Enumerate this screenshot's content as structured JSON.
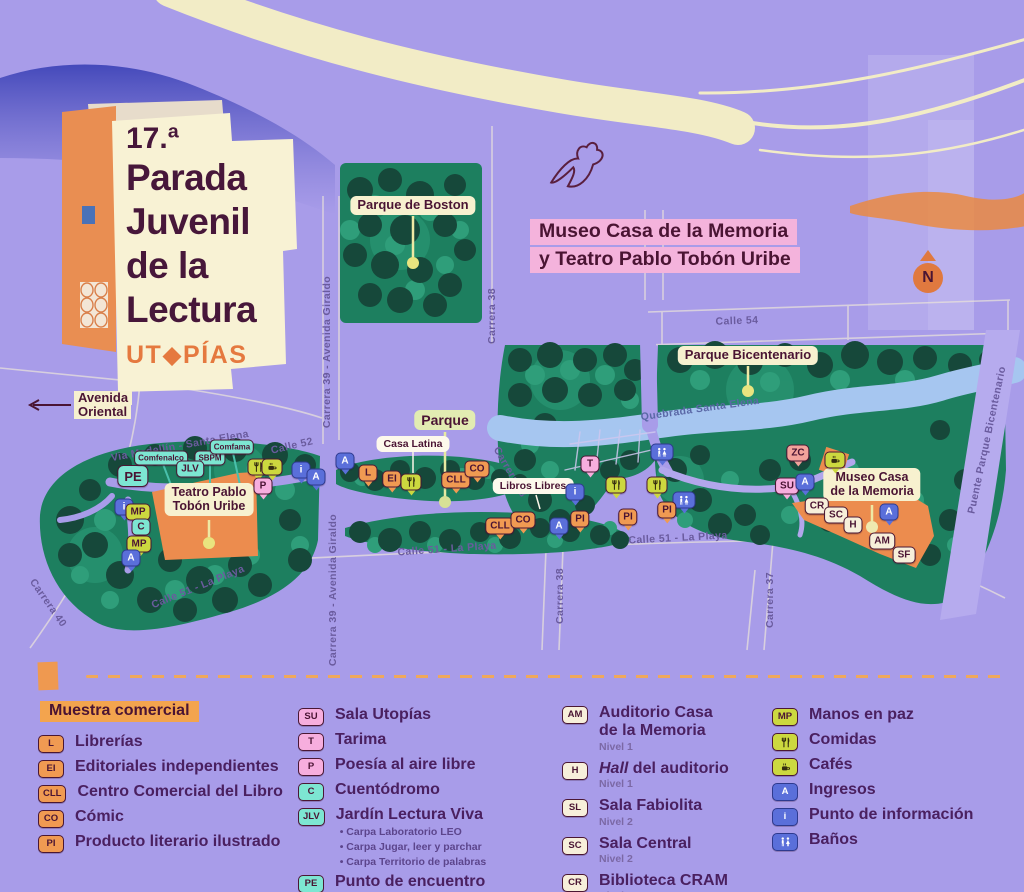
{
  "title": {
    "edition": "17.ª",
    "lines": [
      "Parada",
      "Juvenil",
      "de la",
      "Lectura"
    ],
    "brand": "UT◆PÍAS"
  },
  "colors": {
    "background": "#a89ce9",
    "park": "#1d7f5f",
    "tree_dark": "#16483a",
    "tree_light": "#2f9e7a",
    "river": "#a6c6f0",
    "building": "#ec8c4e",
    "label_cream": "#f7f1cf",
    "banner_pink": "#f4b3dc",
    "text_maroon": "#4a1433",
    "street_text": "#6a5b9e",
    "badge_orange": "#f09a52",
    "badge_pink": "#f7aede",
    "badge_teal": "#7de6d2",
    "badge_cream": "#f7efda",
    "badge_yellow": "#ccd83f",
    "badge_blue": "#5a6fda",
    "badge_salmon": "#f2a29b",
    "brand_orange": "#e5793f"
  },
  "map": {
    "compass": "N",
    "banner": [
      "Museo Casa de la Memoria",
      "y Teatro Pablo Tobón Uribe"
    ],
    "oriental": [
      "Avenida",
      "Oriental"
    ],
    "area_labels": [
      {
        "lines": [
          "Parque de Boston"
        ],
        "x": 413,
        "y": 205,
        "style": "cream",
        "size": 13
      },
      {
        "lines": [
          "Parque Bicentenario"
        ],
        "x": 748,
        "y": 355,
        "style": "cream",
        "size": 13
      },
      {
        "lines": [
          "Museo Casa",
          "de la Memoria"
        ],
        "x": 872,
        "y": 477,
        "style": "cream",
        "size": 12.5
      },
      {
        "lines": [
          "Teatro Pablo",
          "Tobón Uribe"
        ],
        "x": 209,
        "y": 492,
        "style": "cream",
        "size": 12.5
      },
      {
        "lines": [
          "Parque"
        ],
        "x": 445,
        "y": 419,
        "style": "pale",
        "size": 14
      },
      {
        "lines": [
          "Casa Latina"
        ],
        "x": 413,
        "y": 445,
        "style": "white",
        "size": 10.5
      },
      {
        "lines": [
          "Libros Libres"
        ],
        "x": 533,
        "y": 487,
        "style": "white",
        "size": 10.5
      }
    ],
    "street_labels": [
      {
        "text": "Via Medellín - Santa Elena",
        "x": 180,
        "y": 446,
        "rot": -10
      },
      {
        "text": "Calle 52",
        "x": 292,
        "y": 446,
        "rot": -13
      },
      {
        "text": "Calle 54",
        "x": 737,
        "y": 321,
        "rot": -2
      },
      {
        "text": "Calle 51 - La Playa",
        "x": 198,
        "y": 587,
        "rot": -22
      },
      {
        "text": "Calle 51 - La Playa",
        "x": 447,
        "y": 549,
        "rot": -4
      },
      {
        "text": "Calle 51 - La Playa",
        "x": 678,
        "y": 538,
        "rot": -3
      },
      {
        "text": "Carrera 40",
        "x": 48,
        "y": 603,
        "rot": 55
      },
      {
        "text": "Carrera 39 - Avenida Giraldo",
        "x": 327,
        "y": 352,
        "rot": -90
      },
      {
        "text": "Carrera 39 - Avenida Giraldo",
        "x": 333,
        "y": 590,
        "rot": -90
      },
      {
        "text": "Carrera 38",
        "x": 492,
        "y": 316,
        "rot": -90
      },
      {
        "text": "Carrera 38",
        "x": 510,
        "y": 472,
        "rot": 60
      },
      {
        "text": "Carrera 38",
        "x": 560,
        "y": 596,
        "rot": -90
      },
      {
        "text": "Carrera 37",
        "x": 770,
        "y": 600,
        "rot": -90
      },
      {
        "text": "Puente Parque Bicentenario",
        "x": 987,
        "y": 440,
        "rot": -78
      },
      {
        "text": "Quebrada Santa Elena",
        "x": 700,
        "y": 409,
        "rot": -8,
        "color": "#5a68a6"
      }
    ],
    "pointer_lines": [
      {
        "x1": 413,
        "y1": 216,
        "x2": 413,
        "y2": 258,
        "c": "#efe9a4",
        "w": 2.5
      },
      {
        "x1": 748,
        "y1": 366,
        "x2": 748,
        "y2": 386,
        "c": "#efe9a4",
        "w": 2.5
      },
      {
        "x1": 872,
        "y1": 505,
        "x2": 872,
        "y2": 521,
        "c": "#efe9a4",
        "w": 2.5
      },
      {
        "x1": 209,
        "y1": 520,
        "x2": 209,
        "y2": 537,
        "c": "#efe9a4",
        "w": 2.5
      },
      {
        "x1": 445,
        "y1": 432,
        "x2": 445,
        "y2": 497,
        "c": "#e6eaa2",
        "w": 2.5
      },
      {
        "x1": 413,
        "y1": 452,
        "x2": 413,
        "y2": 473,
        "c": "#fbf6e8",
        "w": 1.5
      },
      {
        "x1": 536,
        "y1": 495,
        "x2": 540,
        "y2": 509,
        "c": "#fbf6e8",
        "w": 1.5
      },
      {
        "x1": 163,
        "y1": 464,
        "x2": 171,
        "y2": 485,
        "c": "#49c0ac",
        "w": 2
      },
      {
        "x1": 210,
        "y1": 464,
        "x2": 210,
        "y2": 485,
        "c": "#49c0ac",
        "w": 2
      },
      {
        "x1": 233,
        "y1": 453,
        "x2": 240,
        "y2": 485,
        "c": "#49c0ac",
        "w": 2
      }
    ],
    "pointer_dots": [
      {
        "x": 413,
        "y": 263,
        "r": 6,
        "c": "#e9e47f"
      },
      {
        "x": 748,
        "y": 391,
        "r": 6,
        "c": "#e9e47f"
      },
      {
        "x": 872,
        "y": 527,
        "r": 6,
        "c": "#efe9b0"
      },
      {
        "x": 209,
        "y": 543,
        "r": 6,
        "c": "#e9e47f"
      },
      {
        "x": 445,
        "y": 502,
        "r": 6,
        "c": "#d7e196"
      }
    ],
    "markers": [
      {
        "code": "PE",
        "kind": "teal",
        "x": 133,
        "y": 476,
        "big": true,
        "flat": true
      },
      {
        "code": "Comfenalco",
        "kind": "teal",
        "x": 161,
        "y": 458,
        "small": true,
        "flat": true
      },
      {
        "code": "SBPM",
        "kind": "teal",
        "x": 210,
        "y": 458,
        "small": true,
        "flat": true
      },
      {
        "code": "Comfama",
        "kind": "teal",
        "x": 232,
        "y": 447,
        "small": true,
        "flat": true
      },
      {
        "code": "JLV",
        "kind": "teal",
        "x": 190,
        "y": 469,
        "flat": true
      },
      {
        "icon": "food",
        "kind": "yellow",
        "x": 258,
        "y": 467
      },
      {
        "icon": "cafe",
        "kind": "yellow",
        "x": 272,
        "y": 467
      },
      {
        "code": "i",
        "kind": "blue",
        "x": 301,
        "y": 470
      },
      {
        "code": "A",
        "kind": "blue",
        "x": 316,
        "y": 477
      },
      {
        "code": "P",
        "kind": "pink",
        "x": 263,
        "y": 486
      },
      {
        "code": "i",
        "kind": "blue",
        "x": 124,
        "y": 507
      },
      {
        "code": "MP",
        "kind": "yellow",
        "x": 138,
        "y": 512
      },
      {
        "code": "C",
        "kind": "teal",
        "x": 141,
        "y": 527
      },
      {
        "code": "MP",
        "kind": "yellow",
        "x": 139,
        "y": 544
      },
      {
        "code": "A",
        "kind": "blue",
        "x": 131,
        "y": 558
      },
      {
        "code": "A",
        "kind": "blue",
        "x": 345,
        "y": 461
      },
      {
        "code": "L",
        "kind": "orange",
        "x": 368,
        "y": 473
      },
      {
        "code": "EI",
        "kind": "orange",
        "x": 392,
        "y": 479
      },
      {
        "icon": "food",
        "kind": "yellow",
        "x": 411,
        "y": 482
      },
      {
        "code": "CLL",
        "kind": "orange",
        "x": 456,
        "y": 480
      },
      {
        "code": "CO",
        "kind": "orange",
        "x": 477,
        "y": 469
      },
      {
        "code": "CLL",
        "kind": "orange",
        "x": 500,
        "y": 526
      },
      {
        "code": "CO",
        "kind": "orange",
        "x": 523,
        "y": 520
      },
      {
        "code": "A",
        "kind": "blue",
        "x": 559,
        "y": 526
      },
      {
        "code": "T",
        "kind": "pink",
        "x": 590,
        "y": 464
      },
      {
        "code": "i",
        "kind": "blue",
        "x": 575,
        "y": 492
      },
      {
        "icon": "food",
        "kind": "yellow",
        "x": 616,
        "y": 485
      },
      {
        "icon": "food",
        "kind": "yellow",
        "x": 657,
        "y": 485
      },
      {
        "icon": "restroom",
        "kind": "blue",
        "x": 662,
        "y": 452
      },
      {
        "icon": "restroom",
        "kind": "blue",
        "x": 684,
        "y": 500
      },
      {
        "code": "PI",
        "kind": "orange",
        "x": 580,
        "y": 519
      },
      {
        "code": "PI",
        "kind": "orange",
        "x": 628,
        "y": 517
      },
      {
        "code": "PI",
        "kind": "orange",
        "x": 667,
        "y": 510
      },
      {
        "code": "ZC",
        "kind": "salmon",
        "x": 798,
        "y": 453
      },
      {
        "icon": "cafe",
        "kind": "yellow",
        "x": 835,
        "y": 460
      },
      {
        "code": "SU",
        "kind": "pink",
        "x": 787,
        "y": 486
      },
      {
        "code": "A",
        "kind": "blue",
        "x": 805,
        "y": 482
      },
      {
        "code": "CR",
        "kind": "cream",
        "x": 817,
        "y": 506,
        "flat": true
      },
      {
        "code": "SC",
        "kind": "cream",
        "x": 836,
        "y": 515,
        "flat": true
      },
      {
        "code": "H",
        "kind": "cream",
        "x": 853,
        "y": 525,
        "flat": true
      },
      {
        "code": "AM",
        "kind": "cream",
        "x": 882,
        "y": 541,
        "flat": true
      },
      {
        "code": "SF",
        "kind": "cream",
        "x": 904,
        "y": 555,
        "flat": true
      },
      {
        "code": "A",
        "kind": "blue",
        "x": 889,
        "y": 512
      }
    ]
  },
  "legend": {
    "section_title": "Muestra comercial",
    "columns": [
      [
        {
          "badge": "L",
          "kind": "orange",
          "label": "Librerías"
        },
        {
          "badge": "EI",
          "kind": "orange",
          "label": "Editoriales independientes"
        },
        {
          "badge": "CLL",
          "kind": "orange",
          "label": "Centro Comercial del Libro"
        },
        {
          "badge": "CO",
          "kind": "orange",
          "label": "Cómic"
        },
        {
          "badge": "PI",
          "kind": "orange",
          "label": "Producto literario ilustrado"
        }
      ],
      [
        {
          "badge": "SU",
          "kind": "pink",
          "label": "Sala Utopías"
        },
        {
          "badge": "T",
          "kind": "pink",
          "label": "Tarima"
        },
        {
          "badge": "P",
          "kind": "pink",
          "label": "Poesía al aire libre"
        },
        {
          "badge": "C",
          "kind": "teal",
          "label": "Cuentódromo"
        },
        {
          "badge": "JLV",
          "kind": "teal",
          "label": "Jardín Lectura Viva",
          "sub": [
            "Carpa Laboratorio LEO",
            "Carpa Jugar, leer y parchar",
            "Carpa Territorio de palabras"
          ]
        },
        {
          "badge": "PE",
          "kind": "teal",
          "label": "Punto de encuentro itinerancias",
          "wrap": 170
        }
      ],
      [
        {
          "badge": "AM",
          "kind": "cream",
          "label": "Auditorio Casa de la Memoria",
          "note": "Nivel 1",
          "wrap": 130
        },
        {
          "badge": "H",
          "kind": "cream",
          "label": "*Hall* del auditorio",
          "note": "Nivel 1"
        },
        {
          "badge": "SL",
          "kind": "cream",
          "label": "Sala Fabiolita",
          "note": "Nivel 2"
        },
        {
          "badge": "SC",
          "kind": "cream",
          "label": "Sala Central",
          "note": "Nivel 2"
        },
        {
          "badge": "CR",
          "kind": "cream",
          "label": "Biblioteca CRAM",
          "note": "Nivel 3"
        },
        {
          "badge": "ZC",
          "kind": "salmon",
          "label": "Zona de *camping*"
        }
      ],
      [
        {
          "badge": "MP",
          "kind": "yellow",
          "label": "Manos en paz"
        },
        {
          "icon": "food",
          "kind": "yellow",
          "label": "Comidas"
        },
        {
          "icon": "cafe",
          "kind": "yellow",
          "label": "Cafés"
        },
        {
          "badge": "A",
          "kind": "blue",
          "label": "Ingresos"
        },
        {
          "badge": "i",
          "kind": "blue",
          "label": "Punto de información"
        },
        {
          "icon": "restroom",
          "kind": "blue",
          "label": "Baños"
        }
      ]
    ]
  }
}
